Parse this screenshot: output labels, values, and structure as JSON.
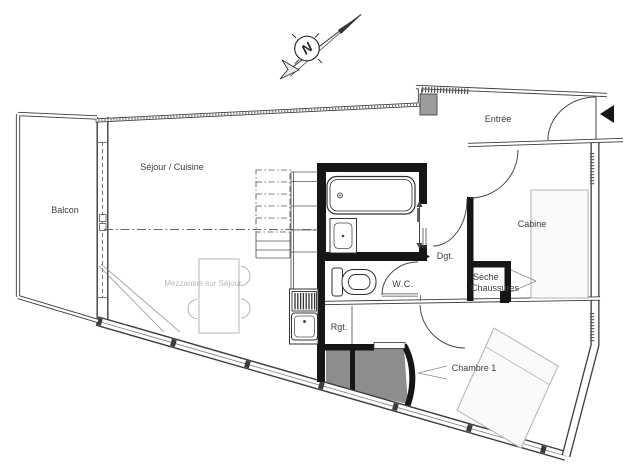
{
  "compass": {
    "north_label": "N"
  },
  "rooms": {
    "balcony": "Balcon",
    "living_kitchen": "Séjour / Cuisine",
    "mezzanine_note": "Mezzanine sur Séjour",
    "entrance": "Entrée",
    "cabin": "Cabine",
    "hallway": "Dgt.",
    "wc": "W.C.",
    "shoe_dryer_line1": "Sèche",
    "shoe_dryer_line2": "Chaussures",
    "storage": "Rgt.",
    "bedroom1": "Chambre 1"
  },
  "colors": {
    "wall_black": "#161616",
    "wall_gray": "#3c3c3c",
    "shaft_gray": "#8d8d8d",
    "furniture_gray": "#b2b2b2",
    "note_gray": "#b9b9b9",
    "paper": "#ffffff"
  }
}
